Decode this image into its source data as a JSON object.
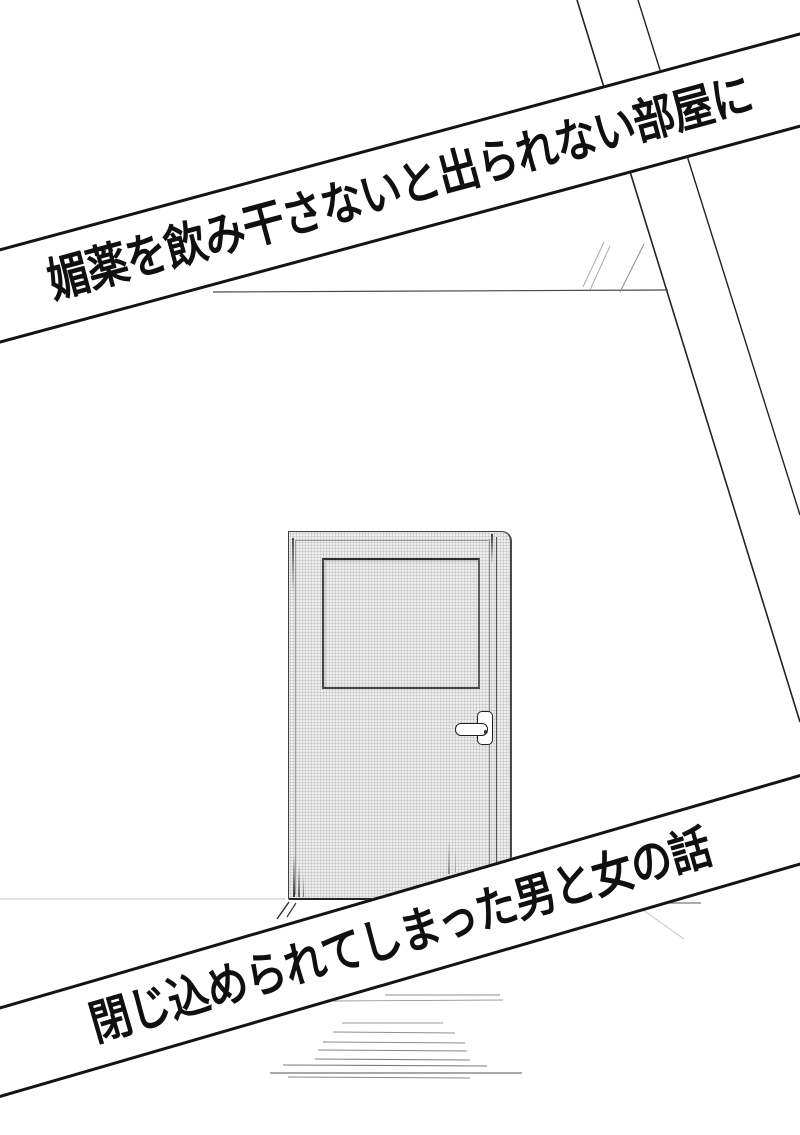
{
  "title_banners": {
    "top": "媚薬を飲み干さないと出られない部屋に",
    "bottom": "閉じ込められてしまった男と女の話"
  },
  "colors": {
    "ink": "#111111",
    "paper": "#ffffff",
    "door_halftone": "#ededed"
  }
}
